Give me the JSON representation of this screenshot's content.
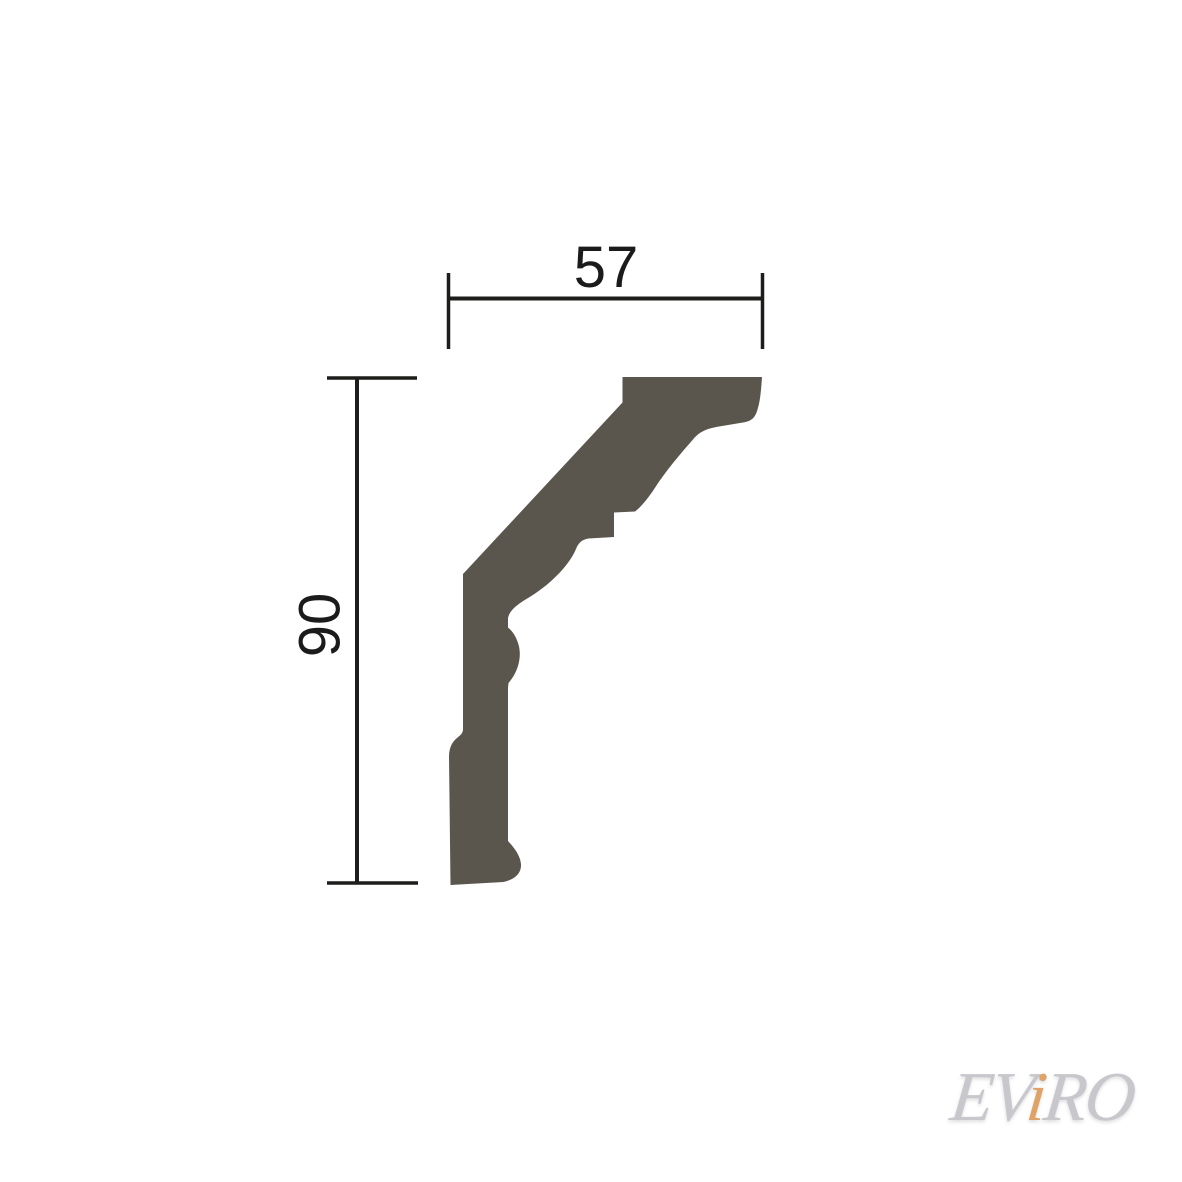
{
  "page": {
    "background": "#ffffff"
  },
  "drawing": {
    "type": "profile-cross-section",
    "subject": "crown-molding-profile",
    "profile_fill_color": "#5a564d",
    "dimension_line_color": "#1d1d1b",
    "dimensions": {
      "width": {
        "value": "57",
        "orientation": "horizontal"
      },
      "height": {
        "value": "90",
        "orientation": "vertical"
      }
    }
  },
  "watermark": {
    "text": "EViRO",
    "segments": [
      {
        "text": "EV",
        "color": "#c7c7cc"
      },
      {
        "text": "i",
        "color": "#dfa367"
      },
      {
        "text": "RO",
        "color": "#c7c7cc"
      }
    ]
  }
}
